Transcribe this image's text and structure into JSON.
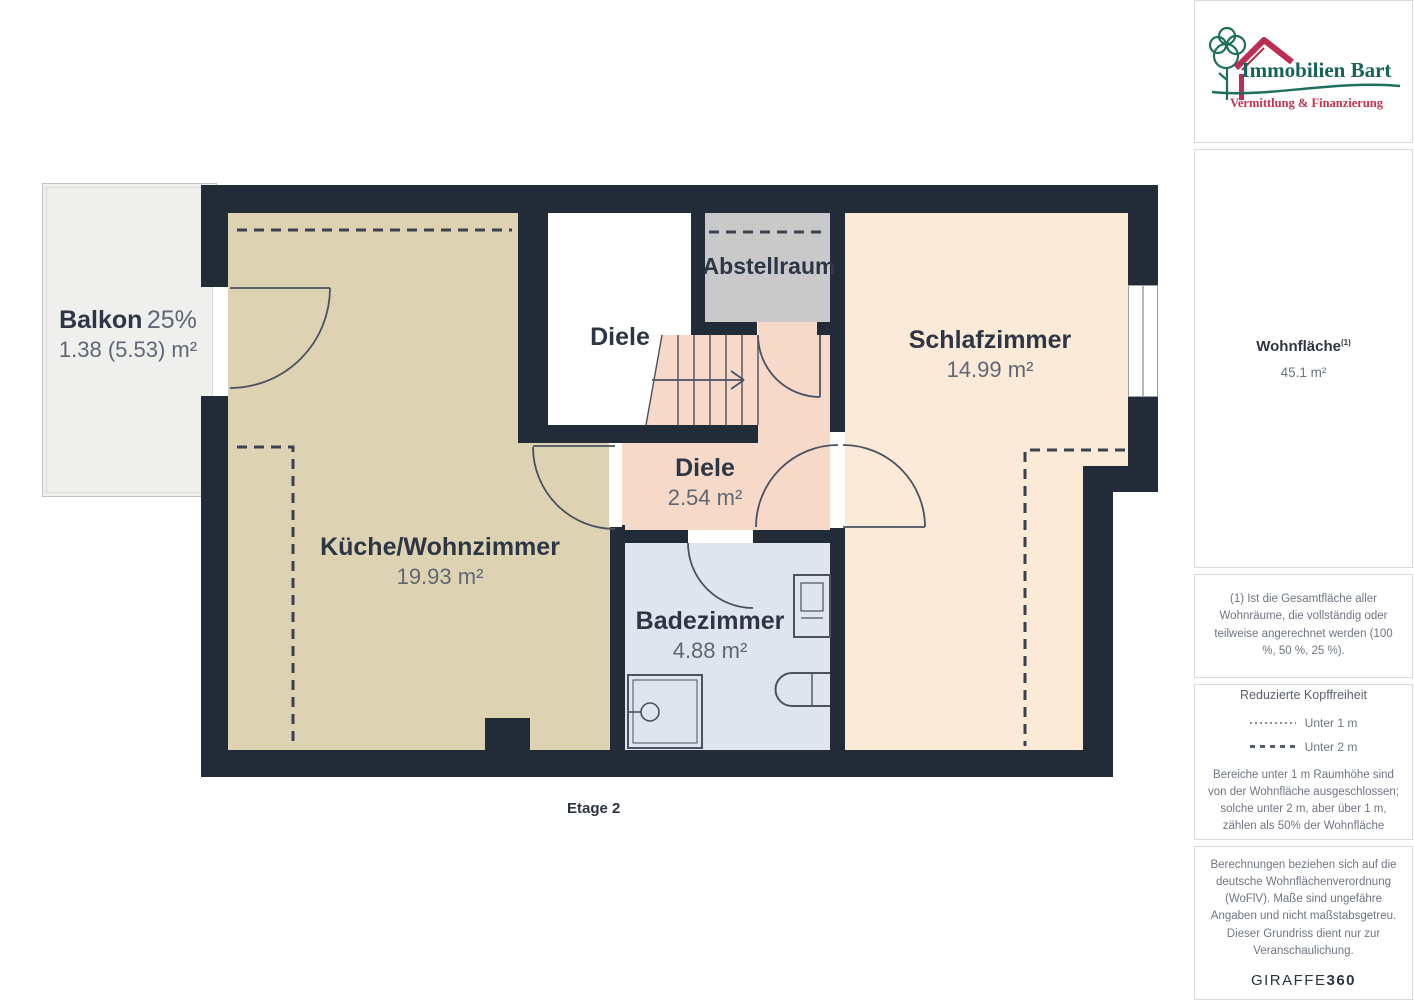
{
  "plan": {
    "floor_label": "Etage 2",
    "rooms": {
      "balkon": {
        "name": "Balkon",
        "share": "25%",
        "area": "1.38 (5.53) m²"
      },
      "kueche": {
        "name": "Küche/Wohnzimmer",
        "area": "19.93 m²"
      },
      "diele_top": {
        "name": "Diele"
      },
      "abstellraum": {
        "name": "Abstellraum"
      },
      "schlafzimmer": {
        "name": "Schlafzimmer",
        "area": "14.99 m²"
      },
      "diele": {
        "name": "Diele",
        "area": "2.54 m²"
      },
      "badezimmer": {
        "name": "Badezimmer",
        "area": "4.88 m²"
      }
    },
    "colors": {
      "wall": "#222b38",
      "kueche": "#ddd3b3",
      "schlafzimmer": "#fcead9",
      "diele": "#f6d9c8",
      "badezimmer": "#dfe4ee",
      "abstellraum": "#c9c9c9",
      "balkon": "#efefed"
    }
  },
  "sidebar": {
    "logo": {
      "brand": "Immobilien Bart",
      "tagline": "Vermittlung & Finanzierung",
      "brand_green": "#17635a",
      "brand_red": "#bb2e52"
    },
    "summary": {
      "label": "Wohnfläche",
      "superscript": "(1)",
      "value": "45.1 m²"
    },
    "note1": "(1) Ist die Gesamtfläche aller Wohnräume, die vollständig oder teilweise angerechnet werden (100 %, 50 %, 25 %).",
    "legend": {
      "title": "Reduzierte Kopffreiheit",
      "items": [
        {
          "style": "dotted",
          "label": "Unter 1 m"
        },
        {
          "style": "dashed",
          "label": "Unter 2 m"
        }
      ],
      "note": "Bereiche unter 1 m Raumhöhe sind von der Wohnfläche ausgeschlossen; solche unter 2 m, aber über 1 m, zählen als 50% der Wohnfläche"
    },
    "disclaimer": "Berechnungen beziehen sich auf die deutsche Wohnflächenverordnung (WoFlV). Maße sind ungefähre Angaben und nicht maßstabsgetreu. Dieser Grundriss dient nur zur Veranschaulichung.",
    "watermark": {
      "part1": "GIRAFFE",
      "part2": "360"
    }
  }
}
